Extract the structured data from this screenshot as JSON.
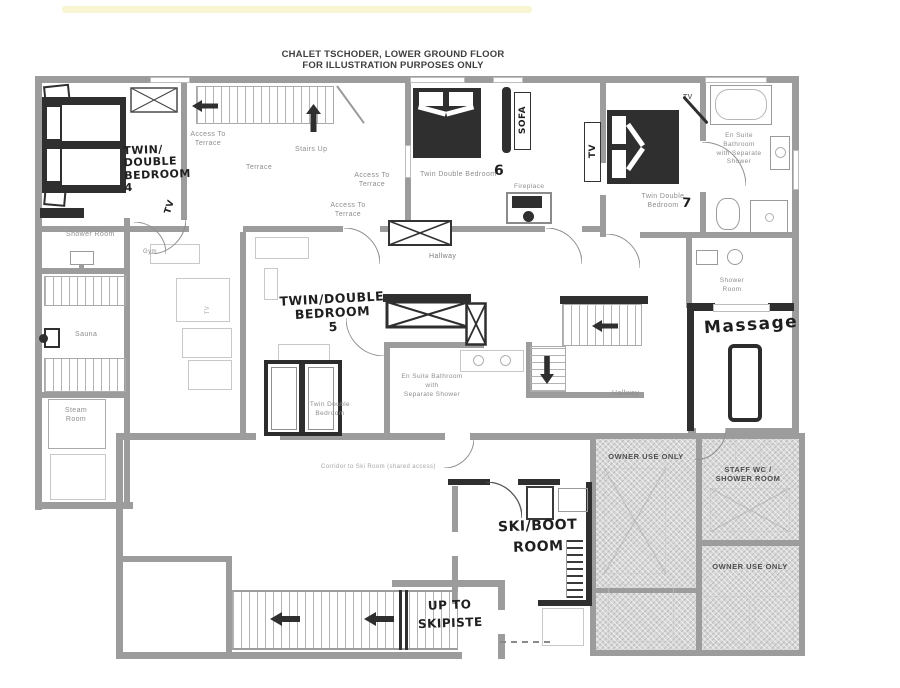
{
  "title": {
    "line1": "CHALET TSCHODER, LOWER GROUND FLOOR",
    "line2": "FOR ILLUSTRATION PURPOSES ONLY"
  },
  "rooms": {
    "bedroom4": "TWIN/\nDOUBLE\nBEDROOM\n4",
    "bedroom5": "TWIN/DOUBLE\nBEDROOM\n5",
    "bedroom5_printed": "Twin Double\nBedroom",
    "bedroom6": "Twin Double Bedroom",
    "bedroom6_number": "6",
    "bedroom7": "Twin Double\nBedroom",
    "bedroom7_number": "7",
    "ensuite7": "En Suite\nBathroom\nwith Separate\nShower",
    "ensuite5": "En Suite Bathroom\nwith\nSeparate Shower",
    "hallway": "Hallway",
    "terrace": "Terrace",
    "sauna": "Sauna",
    "steam_room": "Steam\nRoom",
    "shower_room": "Shower Room",
    "shower_room_2": "Shower\nRoom",
    "gym": "Gym",
    "massage": "Massage",
    "ski_boot_room": "SKI/BOOT\nROOM",
    "up_to_ski_piste": "UP TO\nSKIPISTE",
    "owner_use_only": "OWNER USE ONLY",
    "staff_wc": "STAFF WC /\nSHOWER ROOM"
  },
  "annotations": {
    "stairs_up": "Stairs Up",
    "access_to_terrace": "Access To\nTerrace",
    "sofa": "SOFA",
    "fireplace": "Fireplace",
    "tv": "TV",
    "corridor_note": "Corridor to Ski Room (shared access)"
  },
  "colors": {
    "wall": "#9c9c9c",
    "marker": "#2f2f2f",
    "hatch_fill": "#d8d8d8",
    "printed_text": "#8e8e8e",
    "handwriting": "#1f1f1f"
  }
}
